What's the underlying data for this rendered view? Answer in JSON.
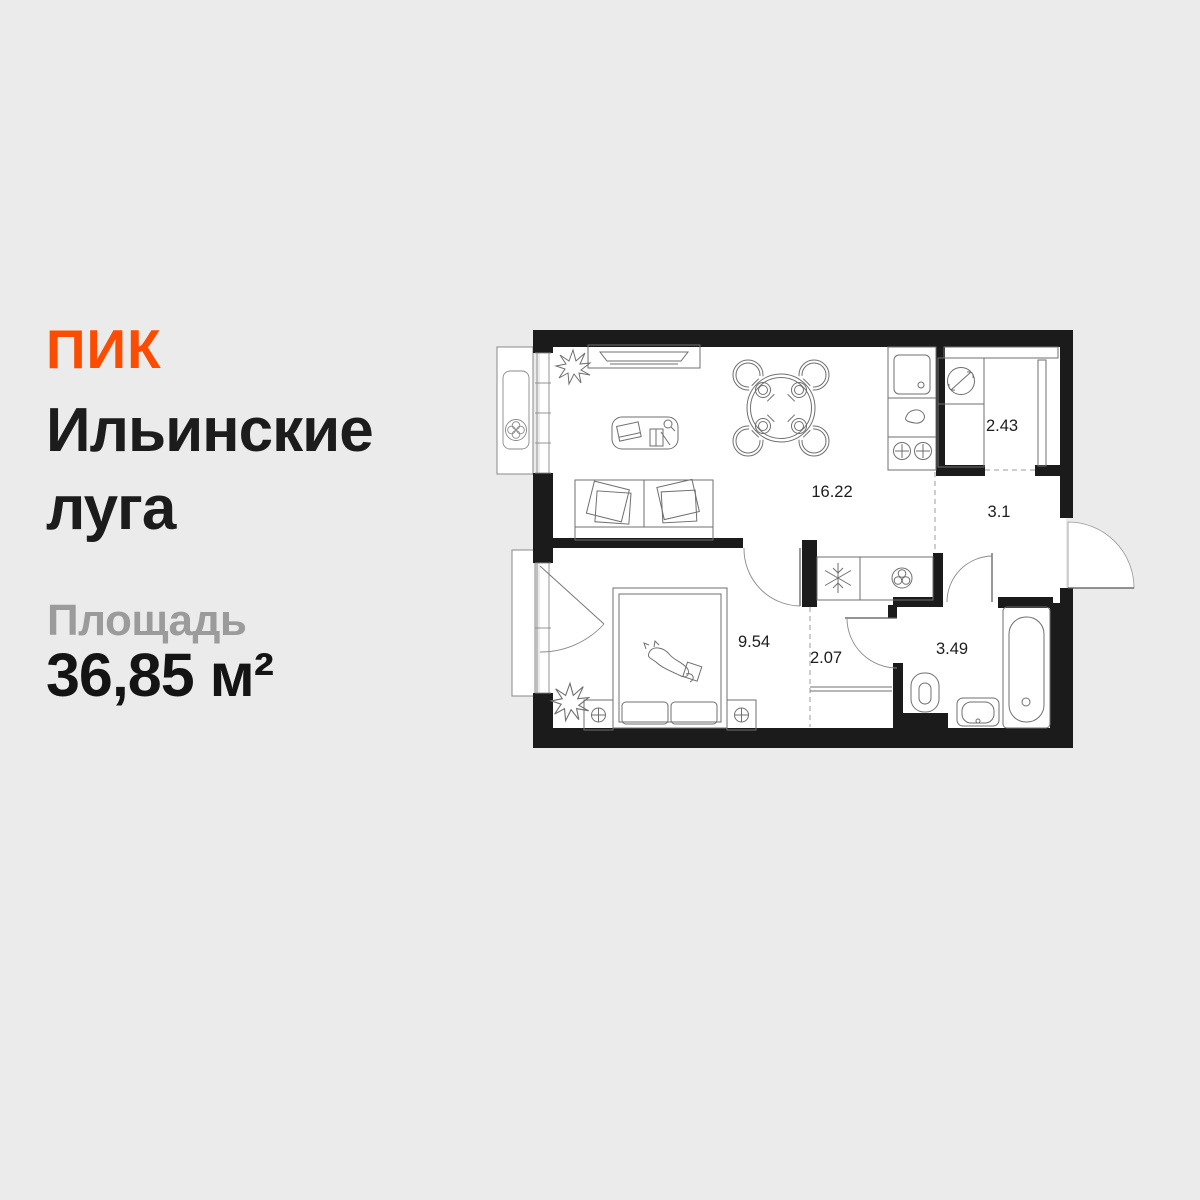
{
  "brand": {
    "logo_text": "ПИК",
    "color": "#FC4C02"
  },
  "project": {
    "title_line1": "Ильинские",
    "title_line2": "луга"
  },
  "area": {
    "label": "Площадь",
    "value": "36,85 м²"
  },
  "floorplan": {
    "total_area": "36,85 м²",
    "rooms": [
      {
        "id": "living-kitchen",
        "area": "16.22"
      },
      {
        "id": "storage-niche",
        "area": "2.43"
      },
      {
        "id": "hallway",
        "area": "3.1"
      },
      {
        "id": "bedroom",
        "area": "9.54"
      },
      {
        "id": "wardrobe",
        "area": "2.07"
      },
      {
        "id": "bathroom",
        "area": "3.49"
      }
    ],
    "icons": [
      "fan-icon",
      "snowflake-icon",
      "ventilation-icon",
      "washing-machine-icon",
      "stove-burners-icon",
      "lamp-icon"
    ],
    "wall_color": "#1B1B1B",
    "background": "#EBEBEB"
  }
}
